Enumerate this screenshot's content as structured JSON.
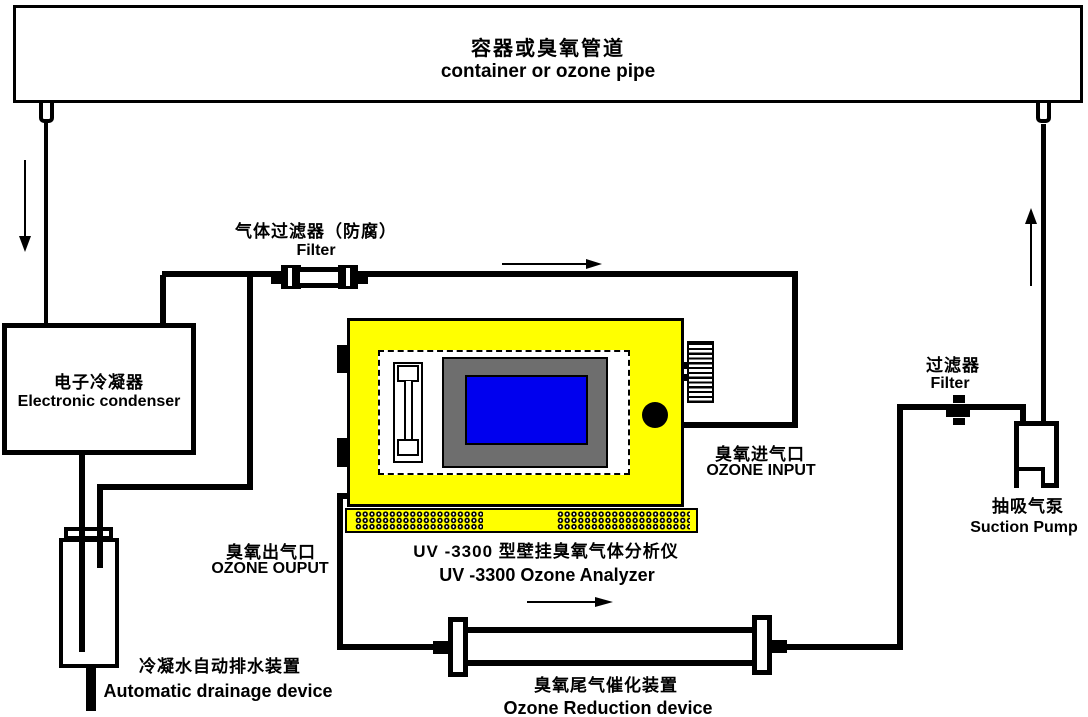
{
  "diagram": {
    "title": {
      "zh": "容器或臭氧管道",
      "en": "container or ozone pipe"
    },
    "components": {
      "gas_filter": {
        "zh": "气体过滤器（防腐）",
        "en": "Filter"
      },
      "condenser": {
        "zh": "电子冷凝器",
        "en": "Electronic condenser"
      },
      "analyzer": {
        "zh": "UV -3300 型壁挂臭氧气体分析仪",
        "en": "UV -3300 Ozone Analyzer"
      },
      "ozone_input": {
        "zh": "臭氧进气口",
        "en": "OZONE INPUT"
      },
      "ozone_output": {
        "zh": "臭氧出气口",
        "en": "OZONE OUPUT"
      },
      "right_filter": {
        "zh": "过滤器",
        "en": "Filter"
      },
      "suction_pump": {
        "zh": "抽吸气泵",
        "en": "Suction Pump"
      },
      "drainage": {
        "zh": "冷凝水自动排水装置",
        "en": "Automatic drainage device"
      },
      "reduction": {
        "zh": "臭氧尾气催化装置",
        "en": "Ozone Reduction device"
      }
    },
    "colors": {
      "analyzer_body": "#FFFF00",
      "screen": "#0000EE",
      "bezel": "#6E6E6E",
      "line": "#000000",
      "background": "#FFFFFF"
    }
  }
}
